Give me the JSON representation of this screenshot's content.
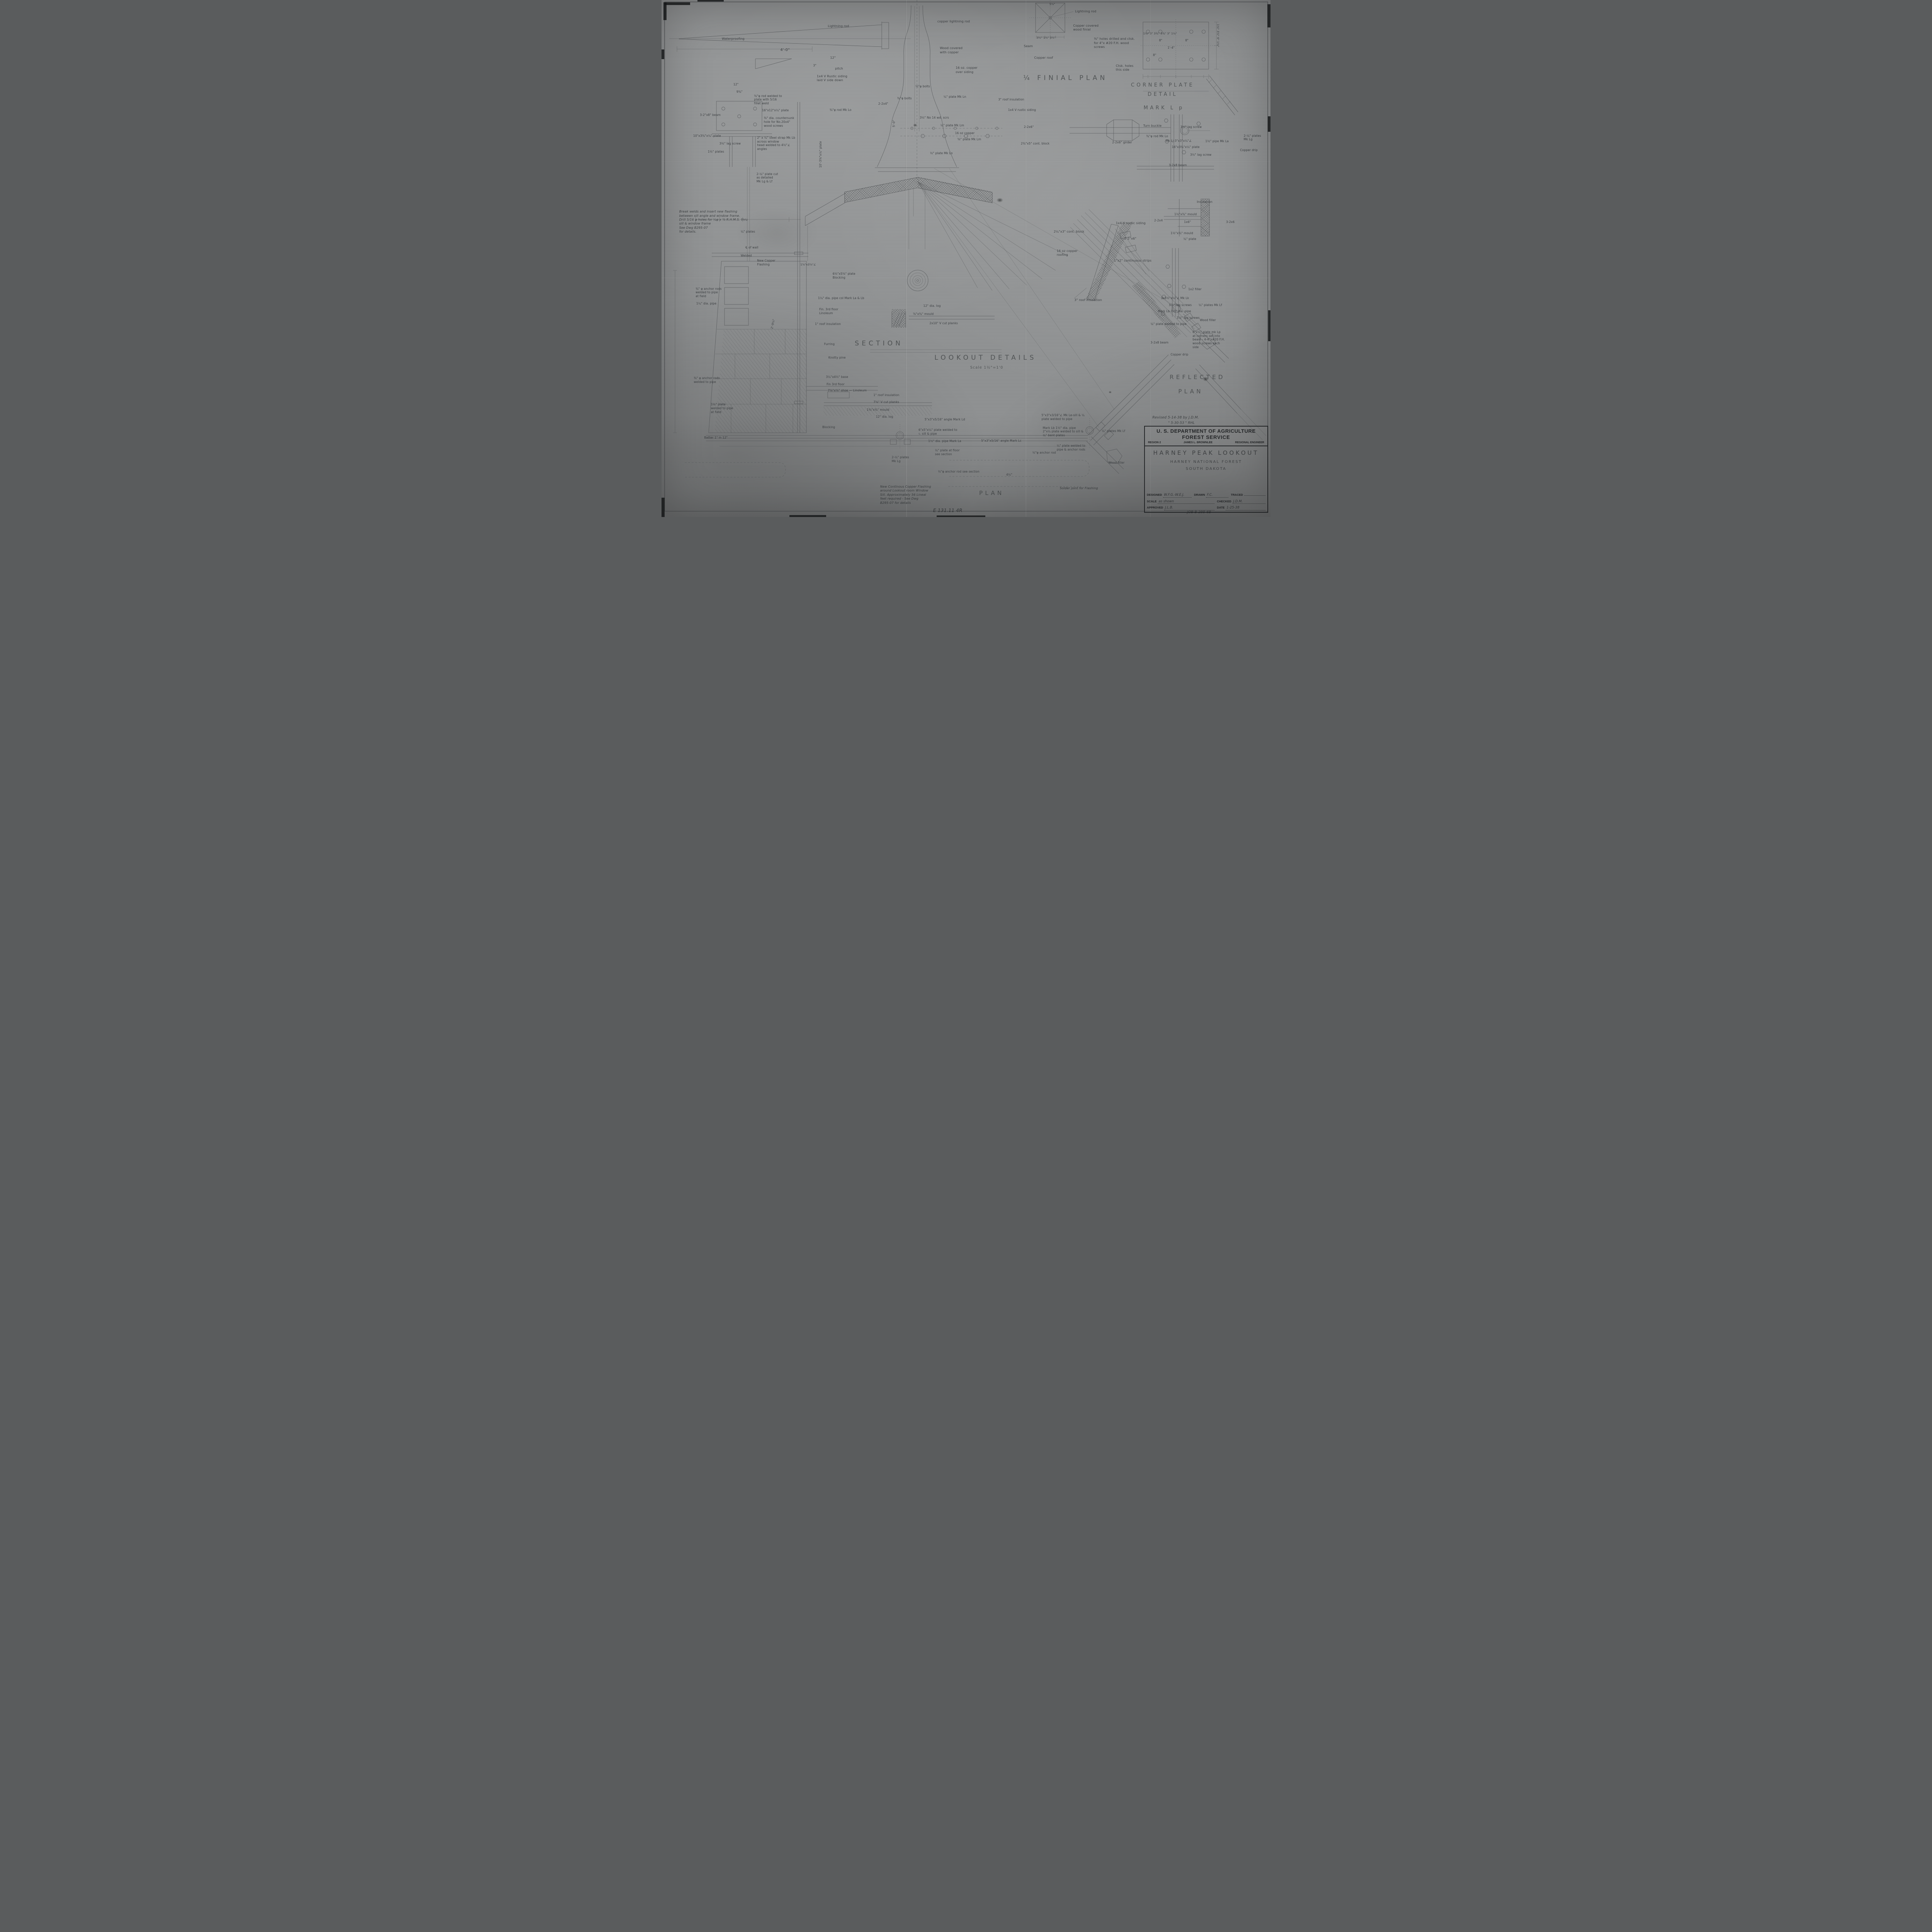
{
  "sheet": {
    "paper_color": "#8f9192",
    "ink_color": "#4b4e50",
    "kind": "scanned pencil architectural drawing"
  },
  "title_block": {
    "agency": "U. S. DEPARTMENT OF AGRICULTURE",
    "service": "FOREST SERVICE",
    "region": "REGION 2",
    "engineer": "JAMES L. BROWNLEE",
    "engineer_title": "REGIONAL ENGINEER",
    "project": "HARNEY PEAK LOOKOUT",
    "forest": "HARNEY NATIONAL FOREST",
    "state": "SOUTH DAKOTA",
    "designed_label": "DESIGNED",
    "designed": "W.F.G.-W.E.J.",
    "drawn_label": "DRAWN",
    "drawn": "F.C.",
    "traced_label": "TRACED",
    "traced": "",
    "scale_label": "SCALE",
    "scale": "as shown",
    "checked_label": "CHECKED",
    "checked": "J.D.M.",
    "approved_label": "APPROVED",
    "approved": "J.L.B.",
    "date_label": "DATE",
    "date": "1-25-38"
  },
  "annotations": [
    {
      "t": "¼ FINIAL PLAN",
      "x": 59.4,
      "y": 14.3,
      "s": 17,
      "cls": "vtitle"
    },
    {
      "t": "CORNER PLATE",
      "x": 82.3,
      "y": 15.9,
      "s": 13,
      "a": "c",
      "cls": "vtitle"
    },
    {
      "t": "DETAIL",
      "x": 82.3,
      "y": 17.7,
      "s": 13,
      "a": "c",
      "cls": "vtitle"
    },
    {
      "t": "MARK L p",
      "x": 82.5,
      "y": 20.3,
      "s": 13,
      "a": "c",
      "cls": "vtitle"
    },
    {
      "t": "SECTION",
      "x": 35.7,
      "y": 65.6,
      "s": 17,
      "a": "c",
      "cls": "vtitle"
    },
    {
      "t": "LOOKOUT DETAILS",
      "x": 53.2,
      "y": 68.4,
      "s": 17,
      "a": "c",
      "cls": "vtitle"
    },
    {
      "t": "Scale 1½\"=1'0",
      "x": 53.4,
      "y": 70.7,
      "s": 9.5,
      "a": "c",
      "cls": "vsub"
    },
    {
      "t": "PLAN",
      "x": 54.2,
      "y": 94.7,
      "s": 15,
      "a": "c",
      "cls": "vtitle"
    },
    {
      "t": "REFLECTED",
      "x": 88.0,
      "y": 72.3,
      "s": 15,
      "a": "c",
      "cls": "vtitle"
    },
    {
      "t": "PLAN",
      "x": 86.9,
      "y": 75.0,
      "s": 15,
      "a": "c",
      "cls": "vtitle"
    },
    {
      "t": "Lightning rod",
      "x": 27.3,
      "y": 4.7
    },
    {
      "t": "Waterproofing",
      "x": 9.9,
      "y": 7.2
    },
    {
      "t": "4'-0\"",
      "x": 19.5,
      "y": 9.2,
      "s": 10
    },
    {
      "t": "12\"",
      "x": 27.7,
      "y": 10.8
    },
    {
      "t": "3\"",
      "x": 24.9,
      "y": 12.3,
      "s": 7.5
    },
    {
      "t": "pitch",
      "x": 28.5,
      "y": 12.9
    },
    {
      "t": "1x4 V Rustic siding\nlaid V side down",
      "x": 25.5,
      "y": 14.4
    },
    {
      "t": "12\"",
      "x": 11.8,
      "y": 16.0,
      "s": 7.5
    },
    {
      "t": "9¾\"",
      "x": 12.3,
      "y": 17.4,
      "s": 7.5
    },
    {
      "t": "⅝\"φ rod welded to\nplate with 5/16\nfillet weld",
      "x": 15.2,
      "y": 18.2,
      "s": 7.5
    },
    {
      "t": "16\"x12\"x¼\" plate",
      "x": 16.5,
      "y": 21.0,
      "s": 7.5
    },
    {
      "t": "⅜\" dia. countersunk\nhole for No.20x4\"\nwood screws",
      "x": 16.8,
      "y": 22.5,
      "s": 7.5
    },
    {
      "t": "3-2\"x8\" beam",
      "x": 6.3,
      "y": 21.9,
      "s": 7.5
    },
    {
      "t": "10\"x3¾\"x¼\" plate",
      "x": 5.2,
      "y": 25.9,
      "s": 7.5
    },
    {
      "t": "3½\" lag screw",
      "x": 9.5,
      "y": 27.4,
      "s": 7.5
    },
    {
      "t": "2\" x ¼\" steel strap Mk Lb\nacross window\nhead welded to 4½\"∠\nangles",
      "x": 15.7,
      "y": 26.3,
      "s": 7.5
    },
    {
      "t": "1½\" plates",
      "x": 7.6,
      "y": 29.0,
      "s": 7.5
    },
    {
      "t": "2-¼\" plate cut\nas detailed\nMk Lg & Lf",
      "x": 15.6,
      "y": 33.3,
      "s": 7.5
    },
    {
      "t": "10'-3⅝\"x¼\" plate",
      "x": 25.8,
      "y": 32.4,
      "s": 7.5,
      "r": -90
    },
    {
      "t": "5'-0\"",
      "x": 37.9,
      "y": 24.6,
      "s": 7.5,
      "r": -90
    },
    {
      "t": "copper lightning rod",
      "x": 45.3,
      "y": 3.8
    },
    {
      "t": "Wood covered\nwith copper",
      "x": 45.7,
      "y": 9.0
    },
    {
      "t": "16 oz. copper\nover siding",
      "x": 48.3,
      "y": 12.8
    },
    {
      "t": "½\"φ bolts",
      "x": 41.7,
      "y": 16.4,
      "s": 7.5
    },
    {
      "t": "¾\"φ bolts",
      "x": 38.7,
      "y": 18.7,
      "s": 7.5
    },
    {
      "t": "¼\" plate Mk Ln",
      "x": 46.3,
      "y": 18.4,
      "s": 7.5
    },
    {
      "t": "2-2x4\"",
      "x": 35.6,
      "y": 19.7,
      "s": 7.5
    },
    {
      "t": "¾\"φ rod Mk Lo",
      "x": 27.6,
      "y": 20.9,
      "s": 7.5
    },
    {
      "t": "3½\" No 14 wd. scrs",
      "x": 42.4,
      "y": 22.4,
      "s": 7.5
    },
    {
      "t": "¼\" plate Mk Lm",
      "x": 45.8,
      "y": 23.9,
      "s": 7.5
    },
    {
      "t": "16 oz copper",
      "x": 48.2,
      "y": 25.4,
      "s": 7.5
    },
    {
      "t": "⅝\" plate Mk Lm",
      "x": 48.6,
      "y": 26.6,
      "s": 7.5
    },
    {
      "t": "½\" plate Mk Ln",
      "x": 44.1,
      "y": 29.3,
      "s": 7.5
    },
    {
      "t": "3\" roof insulation",
      "x": 55.3,
      "y": 18.9,
      "s": 7.5
    },
    {
      "t": "1x4 V rustic siding",
      "x": 56.9,
      "y": 20.9,
      "s": 7.5
    },
    {
      "t": "2-2x6\"",
      "x": 59.5,
      "y": 24.2,
      "s": 7.5
    },
    {
      "t": "2¾\"x5\" cont. block",
      "x": 59.0,
      "y": 27.4,
      "s": 7.5
    },
    {
      "t": "Lightning rod",
      "x": 67.9,
      "y": 1.9
    },
    {
      "t": "Copper covered\nwood finial",
      "x": 67.6,
      "y": 4.6
    },
    {
      "t": "⅜\" holes drilled and ctsk.\nfor 4\"x #20 F.H. wood\nscrews",
      "x": 71.0,
      "y": 7.2
    },
    {
      "t": "Seam",
      "x": 59.5,
      "y": 8.6
    },
    {
      "t": "Copper roof",
      "x": 61.2,
      "y": 10.8
    },
    {
      "t": "3½\"  1½\"  3½\"",
      "x": 61.6,
      "y": 7.0,
      "s": 7
    },
    {
      "t": "5⅛\"",
      "x": 63.7,
      "y": 0.5,
      "s": 7
    },
    {
      "t": "Ctsk. holes\nthis side",
      "x": 74.6,
      "y": 12.4
    },
    {
      "t": "1¼\"  3\"  3¾\"     3¾\"  3\"  1¼\"",
      "x": 79.1,
      "y": 6.2,
      "s": 7
    },
    {
      "t": "8\"",
      "x": 81.7,
      "y": 7.5,
      "s": 7.5
    },
    {
      "t": "8\"",
      "x": 86.0,
      "y": 7.5,
      "s": 7.5
    },
    {
      "t": "1'-4\"",
      "x": 83.1,
      "y": 8.9,
      "s": 7.5
    },
    {
      "t": "8\"",
      "x": 80.7,
      "y": 10.3,
      "s": 7.5
    },
    {
      "t": "1¼\"  3½\"  6\"  1¼\"",
      "x": 91.6,
      "y": 4.6,
      "s": 7,
      "r": 90
    },
    {
      "t": "Turn buckle",
      "x": 79.1,
      "y": 24.0
    },
    {
      "t": "3½\" lag screw",
      "x": 85.2,
      "y": 24.2,
      "s": 7.5
    },
    {
      "t": "¾\"φ rod  Mk Lo",
      "x": 79.6,
      "y": 26.0,
      "s": 7.5
    },
    {
      "t": "2-2x6\" girder",
      "x": 74.0,
      "y": 27.2,
      "s": 7.5
    },
    {
      "t": "Mk Lj-3\"x3\"x¼\"∠",
      "x": 82.8,
      "y": 26.9,
      "s": 7.5
    },
    {
      "t": "1½\" pipe Mk La",
      "x": 89.3,
      "y": 27.0,
      "s": 7.5
    },
    {
      "t": "16\"x3¾\"x¼\" plate",
      "x": 83.8,
      "y": 28.1,
      "s": 7.5
    },
    {
      "t": "2-¼\" plates\nMk Lg",
      "x": 95.6,
      "y": 25.9,
      "s": 7.5
    },
    {
      "t": "3½\" lag screw",
      "x": 86.8,
      "y": 29.6,
      "s": 7.5
    },
    {
      "t": "Copper drip",
      "x": 95.0,
      "y": 28.7,
      "s": 7.5
    },
    {
      "t": "3-2x8 beam",
      "x": 83.3,
      "y": 31.6,
      "s": 7.5
    },
    {
      "t": "Insulation",
      "x": 87.9,
      "y": 38.7
    },
    {
      "t": "1½\"x¾\" mould",
      "x": 84.2,
      "y": 41.1,
      "s": 7.5
    },
    {
      "t": "2-2x4",
      "x": 80.9,
      "y": 42.3,
      "s": 7.5
    },
    {
      "t": "1x6\"",
      "x": 85.8,
      "y": 42.6,
      "s": 7.5
    },
    {
      "t": "3-2x6",
      "x": 92.7,
      "y": 42.6,
      "s": 7.5
    },
    {
      "t": "1½\"x¾\" mould",
      "x": 83.6,
      "y": 44.8,
      "s": 7.5
    },
    {
      "t": "¼\" plate",
      "x": 85.7,
      "y": 45.9,
      "s": 7.5
    },
    {
      "t": "2¼\"x3\" cont. block",
      "x": 64.4,
      "y": 44.5
    },
    {
      "t": "1x4 V rustic siding",
      "x": 74.6,
      "y": 42.8
    },
    {
      "t": "2-2\"x6\"",
      "x": 76.0,
      "y": 45.8
    },
    {
      "t": "16 oz copper\nroofing",
      "x": 64.9,
      "y": 48.2
    },
    {
      "t": "1\"x2\" continuous strips",
      "x": 74.3,
      "y": 50.1
    },
    {
      "t": "3\" roof insulation",
      "x": 67.8,
      "y": 57.7
    },
    {
      "t": "1x2 filler",
      "x": 86.5,
      "y": 55.6,
      "s": 7.5
    },
    {
      "t": "3x3½\"x¼\"∠ Mk Lk",
      "x": 82.0,
      "y": 57.3,
      "s": 7.5
    },
    {
      "t": "3½\" lag screws",
      "x": 83.3,
      "y": 58.7,
      "s": 7.5
    },
    {
      "t": "Mark Lb-1½\" dia. pipe",
      "x": 81.5,
      "y": 59.9,
      "s": 7.5
    },
    {
      "t": "3½\" lag screws",
      "x": 84.6,
      "y": 61.1,
      "s": 7.5
    },
    {
      "t": "¼\" plate welded to pipe",
      "x": 80.3,
      "y": 62.3,
      "s": 7.5
    },
    {
      "t": "¼\" plates Mk Lf",
      "x": 88.2,
      "y": 58.7,
      "s": 7.5
    },
    {
      "t": "Wood filler",
      "x": 88.4,
      "y": 61.6,
      "s": 7.5
    },
    {
      "t": "6\"x¼\" plate mk Lp\nat corners set into\nbeam - 4-4\"x#20 F.H.\nwood screws each\nside",
      "x": 87.2,
      "y": 63.9,
      "s": 7.5
    },
    {
      "t": "3-2x8 beam",
      "x": 80.3,
      "y": 65.9,
      "s": 7.5
    },
    {
      "t": "Copper drip",
      "x": 83.6,
      "y": 68.2,
      "s": 7.5
    },
    {
      "t": "Break welds and insert new flashing\nbetween sill angle and window frame.\nDrill 5/16 φ holes for ¼φ x ⅞ R.H.M.S. thru\nsill & window frame\nSee Dwg B295-07\nfor details.",
      "x": 2.9,
      "y": 40.6,
      "s": 8,
      "cls": "hand"
    },
    {
      "t": "¼\" plates",
      "x": 13.0,
      "y": 44.5,
      "s": 7.5
    },
    {
      "t": "℄ of wall",
      "x": 13.8,
      "y": 47.5,
      "s": 7.5
    },
    {
      "t": "Welded",
      "x": 13.0,
      "y": 49.1,
      "s": 7.5
    },
    {
      "t": "New Copper\nFlashing",
      "x": 15.7,
      "y": 50.1,
      "s": 7.5
    },
    {
      "t": "1⅝\"x3⅝\"∠",
      "x": 22.8,
      "y": 50.9,
      "s": 7
    },
    {
      "t": "6½\"x5⅝\" plate\nBlocking",
      "x": 28.1,
      "y": 52.6,
      "s": 7.5
    },
    {
      "t": "¾\" φ anchor rods\nwelded to pipe\nat field",
      "x": 5.6,
      "y": 55.5,
      "s": 7.5
    },
    {
      "t": "1¼\" dia. pipe",
      "x": 5.7,
      "y": 58.4,
      "s": 7.5
    },
    {
      "t": "1¼\" dia. pipe col Mark La & Lb",
      "x": 25.7,
      "y": 57.3,
      "s": 7.5
    },
    {
      "t": "Fin. 3rd floor\nLinoleum",
      "x": 25.9,
      "y": 59.5,
      "s": 7.5
    },
    {
      "t": "1\" roof insulation",
      "x": 25.2,
      "y": 62.3,
      "s": 7.5
    },
    {
      "t": "12\" dia. log",
      "x": 43.0,
      "y": 58.8,
      "s": 7.5
    },
    {
      "t": "⅝\"x¾\" mould",
      "x": 41.3,
      "y": 60.4,
      "s": 7.5
    },
    {
      "t": "2x10\" V cut planks",
      "x": 44.0,
      "y": 62.2,
      "s": 7.5
    },
    {
      "t": "2'-9¼\"",
      "x": 17.8,
      "y": 63.5,
      "s": 7.5,
      "r": -78
    },
    {
      "t": "Furring",
      "x": 26.7,
      "y": 66.2,
      "s": 7.5
    },
    {
      "t": "Knotty pine",
      "x": 27.4,
      "y": 68.8,
      "s": 7.5
    },
    {
      "t": "¾\" φ anchor rods\nwelded to pipe",
      "x": 5.3,
      "y": 72.8,
      "s": 7.5
    },
    {
      "t": "3¼\"x4½\" base",
      "x": 27.0,
      "y": 72.6,
      "s": 7.5
    },
    {
      "t": "Fin 3rd floor",
      "x": 27.1,
      "y": 74.0,
      "s": 7.5
    },
    {
      "t": "7⅝\"x⅝\" shoe — Linoleum",
      "x": 27.3,
      "y": 75.2,
      "s": 7.5
    },
    {
      "t": "1\" roof insulation",
      "x": 34.8,
      "y": 76.1,
      "s": 7.5
    },
    {
      "t": "7⅝\" V cut planks",
      "x": 34.8,
      "y": 77.4,
      "s": 7.5
    },
    {
      "t": "1¼\" plate\nwelded to pipe\nat field",
      "x": 8.1,
      "y": 77.9,
      "s": 7.5
    },
    {
      "t": "1¾\"x¾\" mould",
      "x": 33.7,
      "y": 78.9,
      "s": 7.5
    },
    {
      "t": "12\" dia. log",
      "x": 35.2,
      "y": 80.3,
      "s": 7.5
    },
    {
      "t": "Blocking",
      "x": 26.4,
      "y": 82.3,
      "s": 7.5
    },
    {
      "t": "Batter 1\" in 12\"",
      "x": 7.0,
      "y": 84.3,
      "s": 7.5
    },
    {
      "t": "5\"x3\"x5/16\" angle Mark Ld",
      "x": 43.2,
      "y": 80.8,
      "s": 7.5
    },
    {
      "t": "6\"x5\"x¼\" plate welded to\n∟ sill & pipe",
      "x": 42.2,
      "y": 82.8,
      "s": 7.5
    },
    {
      "t": "1½\" dia. pipe  Mark La",
      "x": 43.8,
      "y": 85.0,
      "s": 7.5
    },
    {
      "t": "5\"x3\"x5/16\" angle Mark Lc",
      "x": 52.5,
      "y": 84.9,
      "s": 7.5
    },
    {
      "t": "5\"x3\"x3/16\"∠ Mk Le-sill & ¼\nplate welded to pipe",
      "x": 62.4,
      "y": 80.0,
      "s": 7.5
    },
    {
      "t": "Mark Lb 1½\" dia. pipe\n2\"x¼ plate welded to sill &\n¼\" bent plates",
      "x": 62.6,
      "y": 82.4,
      "s": 7.5
    },
    {
      "t": "¼\" plates Mk Lf",
      "x": 72.3,
      "y": 83.0,
      "s": 7.5
    },
    {
      "t": "¼\" plate at floor\nsee section",
      "x": 44.9,
      "y": 86.8,
      "s": 7.5
    },
    {
      "t": "2-¼\" plates\nMk Lg",
      "x": 37.8,
      "y": 88.1,
      "s": 7.5
    },
    {
      "t": "¼\" plate welded to\npipe & anchor rods",
      "x": 64.9,
      "y": 85.9,
      "s": 7.5
    },
    {
      "t": "½\"φ anchor rod",
      "x": 60.9,
      "y": 87.2,
      "s": 7.5
    },
    {
      "t": "½\"φ anchor rod  see section",
      "x": 45.4,
      "y": 90.9,
      "s": 7.5
    },
    {
      "t": "Wood filler",
      "x": 73.4,
      "y": 89.2,
      "s": 7.5
    },
    {
      "t": "4½\"",
      "x": 56.6,
      "y": 91.5,
      "s": 7.5
    },
    {
      "t": "New Continous Copper Flashing\naround Lookout room Window\nSill. Approximately  56 Lineal\nfeet required - See Dwg\nB295-07 for details",
      "x": 35.9,
      "y": 93.8,
      "s": 8,
      "cls": "hand"
    },
    {
      "t": "Solder joint for Flashing",
      "x": 65.4,
      "y": 94.1,
      "s": 8,
      "cls": "hand"
    },
    {
      "t": "Revised 5-14-38 by  J.D.M.",
      "x": 80.6,
      "y": 80.4,
      "s": 9,
      "cls": "hand"
    },
    {
      "t": "\"  5-30-53  \"    RHL",
      "x": 83.2,
      "y": 81.5,
      "s": 8.5,
      "cls": "hand"
    },
    {
      "t": "E 131.11 4R",
      "x": 44.6,
      "y": 98.2,
      "s": 12,
      "cls": "hand"
    },
    {
      "t": "JOB  B-295-6B",
      "x": 86.3,
      "y": 98.7,
      "s": 9,
      "cls": "hand"
    }
  ]
}
